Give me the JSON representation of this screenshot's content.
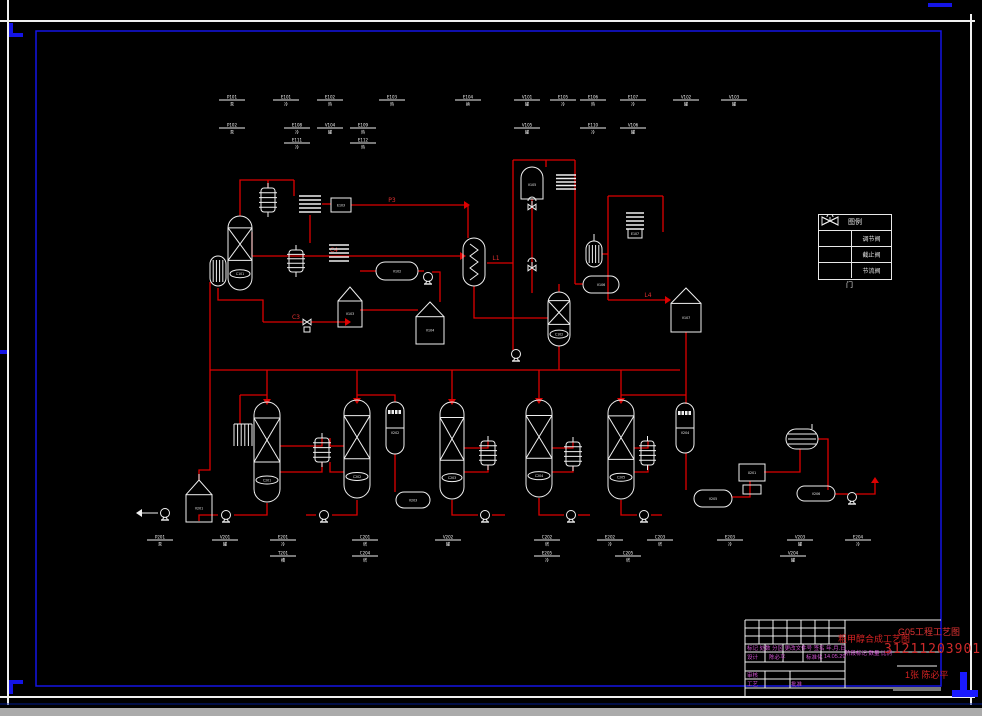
{
  "drawing": {
    "bg": "#000000",
    "pipe_color": "#dd0000",
    "equip_color": "#f0f0f0",
    "accent_blue": "#1414e6",
    "magenta": "#d152d1",
    "red_text": "#d42222"
  },
  "title_block": {
    "rev_row": "标记 处数 分区 更改文件号 签名 年.月.日",
    "design_label": "设计",
    "designer": "陈必平",
    "std_label": "标准化",
    "date": "14.05.29",
    "stage_row": "阶段标记  数量  比例",
    "check_label": "审核",
    "craft_label": "工艺",
    "approve_label": "批准",
    "title": "粗甲醇合成工艺图",
    "project": "G05工程工艺图",
    "number": "3121120390119",
    "sheet": "1张 陈必平"
  },
  "legend": {
    "header": "图例",
    "caption": "门",
    "rows": [
      {
        "symbol": "control-valve",
        "name": "调节阀"
      },
      {
        "symbol": "stop-valve",
        "name": "截止阀"
      },
      {
        "symbol": "throttle-valve",
        "name": "节流阀"
      }
    ]
  },
  "diagram": {
    "equipment": [
      {
        "t": "finned",
        "x": 261,
        "y": 188,
        "w": 14,
        "h": 24,
        "label": ""
      },
      {
        "t": "coil",
        "x": 299,
        "y": 194,
        "w": 22,
        "h": 20,
        "label": ""
      },
      {
        "t": "box",
        "x": 331,
        "y": 198,
        "w": 20,
        "h": 14,
        "label": "E103"
      },
      {
        "t": "column",
        "x": 228,
        "y": 216,
        "w": 24,
        "h": 74,
        "label": "C101"
      },
      {
        "t": "hatch",
        "x": 210,
        "y": 256,
        "w": 16,
        "h": 30,
        "label": ""
      },
      {
        "t": "finned",
        "x": 289,
        "y": 250,
        "w": 14,
        "h": 22,
        "label": ""
      },
      {
        "t": "coil",
        "x": 329,
        "y": 243,
        "w": 20,
        "h": 20,
        "label": ""
      },
      {
        "t": "capsuleh",
        "x": 376,
        "y": 262,
        "w": 42,
        "h": 18,
        "label": "V102"
      },
      {
        "t": "tank",
        "x": 338,
        "y": 287,
        "w": 24,
        "h": 40,
        "label": "V103"
      },
      {
        "t": "tank",
        "x": 416,
        "y": 302,
        "w": 28,
        "h": 42,
        "label": "V104"
      },
      {
        "t": "zigzag",
        "x": 463,
        "y": 238,
        "w": 22,
        "h": 48,
        "label": ""
      },
      {
        "t": "domev",
        "x": 521,
        "y": 167,
        "w": 22,
        "h": 32,
        "label": "V105"
      },
      {
        "t": "coil",
        "x": 556,
        "y": 173,
        "w": 20,
        "h": 18,
        "label": ""
      },
      {
        "t": "coil",
        "x": 626,
        "y": 211,
        "w": 18,
        "h": 20,
        "label": ""
      },
      {
        "t": "box",
        "x": 628,
        "y": 229,
        "w": 14,
        "h": 9,
        "label": "E107"
      },
      {
        "t": "hatch",
        "x": 586,
        "y": 241,
        "w": 16,
        "h": 26,
        "label": ""
      },
      {
        "t": "capsuleh",
        "x": 583,
        "y": 276,
        "w": 36,
        "h": 17,
        "label": "V106"
      },
      {
        "t": "column",
        "x": 548,
        "y": 292,
        "w": 22,
        "h": 54,
        "label": "C102"
      },
      {
        "t": "tank",
        "x": 671,
        "y": 288,
        "w": 30,
        "h": 44,
        "label": "V107"
      },
      {
        "t": "tank",
        "x": 186,
        "y": 480,
        "w": 26,
        "h": 42,
        "label": "V201"
      },
      {
        "t": "comb",
        "x": 234,
        "y": 424,
        "w": 18,
        "h": 22,
        "label": ""
      },
      {
        "t": "column",
        "x": 254,
        "y": 402,
        "w": 26,
        "h": 100,
        "label": "C201"
      },
      {
        "t": "finned",
        "x": 315,
        "y": 438,
        "w": 14,
        "h": 24,
        "label": ""
      },
      {
        "t": "column",
        "x": 344,
        "y": 400,
        "w": 26,
        "h": 98,
        "label": "C202"
      },
      {
        "t": "checker",
        "x": 386,
        "y": 402,
        "w": 18,
        "h": 52,
        "label": "V202"
      },
      {
        "t": "capsuleh",
        "x": 396,
        "y": 492,
        "w": 34,
        "h": 16,
        "label": "V203"
      },
      {
        "t": "column",
        "x": 440,
        "y": 402,
        "w": 24,
        "h": 97,
        "label": "C203"
      },
      {
        "t": "finned",
        "x": 481,
        "y": 441,
        "w": 14,
        "h": 24,
        "label": ""
      },
      {
        "t": "column",
        "x": 526,
        "y": 400,
        "w": 26,
        "h": 97,
        "label": "C204"
      },
      {
        "t": "finned",
        "x": 566,
        "y": 442,
        "w": 14,
        "h": 24,
        "label": ""
      },
      {
        "t": "column",
        "x": 608,
        "y": 400,
        "w": 26,
        "h": 99,
        "label": "C205"
      },
      {
        "t": "finned",
        "x": 641,
        "y": 441,
        "w": 13,
        "h": 24,
        "label": ""
      },
      {
        "t": "checker",
        "x": 676,
        "y": 403,
        "w": 18,
        "h": 50,
        "label": "V204"
      },
      {
        "t": "capsuleh",
        "x": 694,
        "y": 490,
        "w": 38,
        "h": 17,
        "label": "V205"
      },
      {
        "t": "machine",
        "x": 739,
        "y": 464,
        "w": 26,
        "h": 17,
        "label": "X201"
      },
      {
        "t": "finnedh",
        "x": 786,
        "y": 429,
        "w": 32,
        "h": 20,
        "label": ""
      },
      {
        "t": "capsuleh",
        "x": 797,
        "y": 486,
        "w": 38,
        "h": 15,
        "label": "V206"
      }
    ],
    "pumps": [
      {
        "x": 428,
        "y": 277
      },
      {
        "x": 516,
        "y": 354
      },
      {
        "x": 165,
        "y": 513
      },
      {
        "x": 226,
        "y": 515
      },
      {
        "x": 324,
        "y": 515
      },
      {
        "x": 485,
        "y": 515
      },
      {
        "x": 571,
        "y": 515
      },
      {
        "x": 644,
        "y": 515
      },
      {
        "x": 852,
        "y": 497
      }
    ],
    "valves": [
      {
        "x": 307,
        "y": 322,
        "act": false
      },
      {
        "x": 532,
        "y": 207,
        "act": true
      },
      {
        "x": 532,
        "y": 268,
        "act": true
      }
    ],
    "pipes": [
      "240,216 240,180 294,180",
      "294,180 294,196",
      "268,188 268,180",
      "310,215 310,243",
      "322,204 331,204",
      "351,205 468,205 468,238",
      "252,256 463,256",
      "487,263 513,263",
      "513,160 513,350",
      "513,160 575,160",
      "575,160 575,284",
      "532,199 532,293",
      "474,286 474,318 548,318",
      "559,346 559,370",
      "575,284 583,284",
      "559,292 559,284",
      "608,196 663,196",
      "608,196 608,300",
      "663,196 663,232",
      "602,254 608,254",
      "608,300 668,300",
      "686,332 686,370",
      "210,282 210,470 199,470 199,480",
      "210,370 680,370",
      "267,370 267,403",
      "357,370 357,401",
      "452,370 452,403",
      "539,370 539,401",
      "621,370 621,401",
      "686,370 686,404",
      "240,395 240,424",
      "240,395 267,395",
      "280,446 322,446 322,438",
      "322,462 322,472 280,472",
      "344,446 330,446 330,438",
      "330,462 330,472 344,472",
      "199,521 199,515 218,515",
      "234,515 267,515 267,503",
      "357,500 357,515 332,515",
      "316,515 306,515",
      "357,395 395,395 395,402",
      "621,395 686,395",
      "395,454 395,492",
      "686,453 686,490",
      "464,448 488,448 488,441",
      "488,465 488,472 464,472",
      "552,448 573,448 573,442",
      "573,466 573,472 552,472",
      "634,448 648,448 648,441",
      "648,465 648,472 634,472",
      "452,500 452,515 478,515",
      "492,515 505,515",
      "539,498 539,515 564,515",
      "578,515 590,515",
      "621,500 621,515 637,515",
      "651,515 662,515",
      "732,497 750,497 750,481",
      "764,472 800,472 800,449",
      "818,439 828,439 828,490",
      "835,494 848,494",
      "856,494 875,494 875,480",
      "218,288 218,300 263,300 263,322",
      "263,322 303,322",
      "311,322 349,322",
      "360,310 418,310",
      "376,271 360,271",
      "418,271 424,271",
      "432,272 440,272 440,302",
      "252,232 252,256",
      "546,160 546,167"
    ],
    "arrows": [
      {
        "x": 460,
        "y": 256,
        "d": "right"
      },
      {
        "x": 665,
        "y": 300,
        "d": "right"
      },
      {
        "x": 267,
        "y": 399,
        "d": "down"
      },
      {
        "x": 357,
        "y": 398,
        "d": "down"
      },
      {
        "x": 452,
        "y": 399,
        "d": "down"
      },
      {
        "x": 539,
        "y": 398,
        "d": "down"
      },
      {
        "x": 621,
        "y": 398,
        "d": "down"
      },
      {
        "x": 875,
        "y": 483,
        "d": "up"
      },
      {
        "x": 464,
        "y": 205,
        "d": "right"
      },
      {
        "x": 345,
        "y": 322,
        "d": "right"
      }
    ],
    "wlines": [
      "158,513 142,513",
      "594,241 594,234",
      "199,480 199,474"
    ],
    "warrows": [
      {
        "x": 142,
        "y": 513,
        "d": "left"
      }
    ],
    "line_labels": [
      {
        "x": 334,
        "y": 252,
        "t": "C4"
      },
      {
        "x": 392,
        "y": 202,
        "t": "P3"
      },
      {
        "x": 496,
        "y": 260,
        "t": "L1"
      },
      {
        "x": 648,
        "y": 297,
        "t": "L4"
      },
      {
        "x": 296,
        "y": 319,
        "t": "C3"
      }
    ],
    "tags_top": [
      {
        "x": 232,
        "y": 100,
        "a": "P101",
        "b": "泵"
      },
      {
        "x": 286,
        "y": 100,
        "a": "E101",
        "b": "冷"
      },
      {
        "x": 330,
        "y": 100,
        "a": "E102",
        "b": "热"
      },
      {
        "x": 392,
        "y": 100,
        "a": "E103",
        "b": "热"
      },
      {
        "x": 468,
        "y": 100,
        "a": "E104",
        "b": "换"
      },
      {
        "x": 527,
        "y": 100,
        "a": "V101",
        "b": "罐"
      },
      {
        "x": 563,
        "y": 100,
        "a": "E105",
        "b": "冷"
      },
      {
        "x": 593,
        "y": 100,
        "a": "E106",
        "b": "热"
      },
      {
        "x": 633,
        "y": 100,
        "a": "E107",
        "b": "冷"
      },
      {
        "x": 686,
        "y": 100,
        "a": "V102",
        "b": "罐"
      },
      {
        "x": 734,
        "y": 100,
        "a": "V103",
        "b": "罐"
      },
      {
        "x": 232,
        "y": 128,
        "a": "P102",
        "b": "泵"
      },
      {
        "x": 297,
        "y": 128,
        "a": "E108",
        "b": "冷"
      },
      {
        "x": 330,
        "y": 128,
        "a": "V104",
        "b": "罐"
      },
      {
        "x": 363,
        "y": 128,
        "a": "E109",
        "b": "热"
      },
      {
        "x": 527,
        "y": 128,
        "a": "V105",
        "b": "罐"
      },
      {
        "x": 593,
        "y": 128,
        "a": "E110",
        "b": "冷"
      },
      {
        "x": 633,
        "y": 128,
        "a": "V106",
        "b": "罐"
      },
      {
        "x": 297,
        "y": 143,
        "a": "E111",
        "b": "冷"
      },
      {
        "x": 363,
        "y": 143,
        "a": "E112",
        "b": "热"
      }
    ],
    "tags_bottom": [
      {
        "x": 160,
        "y": 540,
        "a": "P201",
        "b": "泵"
      },
      {
        "x": 225,
        "y": 540,
        "a": "V201",
        "b": "罐"
      },
      {
        "x": 283,
        "y": 540,
        "a": "E201",
        "b": "冷"
      },
      {
        "x": 365,
        "y": 540,
        "a": "C201",
        "b": "塔"
      },
      {
        "x": 448,
        "y": 540,
        "a": "V202",
        "b": "罐"
      },
      {
        "x": 547,
        "y": 540,
        "a": "C202",
        "b": "塔"
      },
      {
        "x": 610,
        "y": 540,
        "a": "E202",
        "b": "冷"
      },
      {
        "x": 660,
        "y": 540,
        "a": "C203",
        "b": "塔"
      },
      {
        "x": 730,
        "y": 540,
        "a": "E203",
        "b": "冷"
      },
      {
        "x": 800,
        "y": 540,
        "a": "V203",
        "b": "罐"
      },
      {
        "x": 858,
        "y": 540,
        "a": "E204",
        "b": "冷"
      },
      {
        "x": 283,
        "y": 556,
        "a": "T201",
        "b": "槽"
      },
      {
        "x": 365,
        "y": 556,
        "a": "C204",
        "b": "塔"
      },
      {
        "x": 547,
        "y": 556,
        "a": "E205",
        "b": "冷"
      },
      {
        "x": 628,
        "y": 556,
        "a": "C205",
        "b": "塔"
      },
      {
        "x": 793,
        "y": 556,
        "a": "V204",
        "b": "罐"
      }
    ]
  }
}
